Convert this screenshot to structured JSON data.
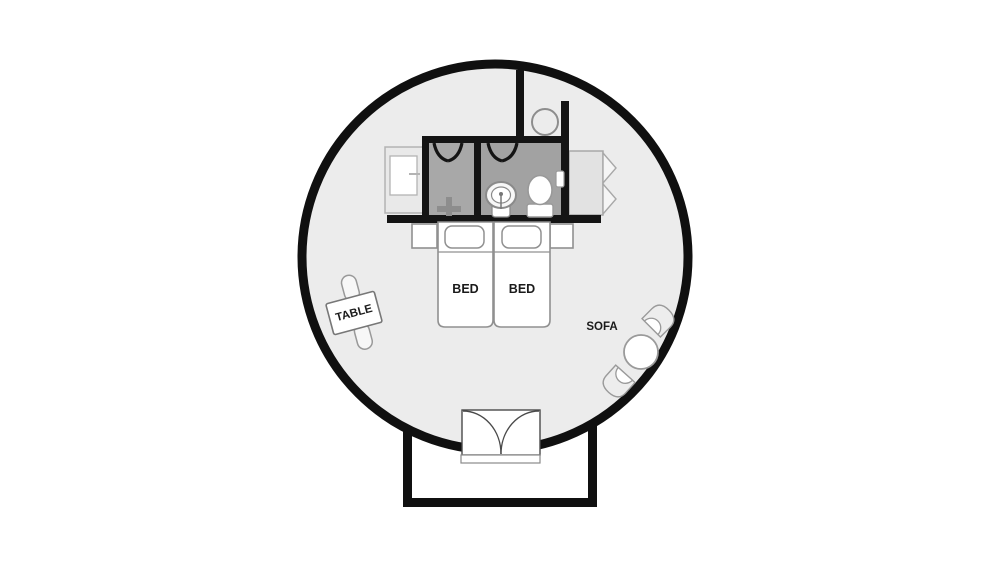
{
  "title": "Circular cabin room floor plan",
  "canvas": {
    "width": 1000,
    "height": 572,
    "background": "#ffffff"
  },
  "room": {
    "shape": "circle",
    "fill": "#ececec",
    "outline_color": "#101010",
    "outline_width": 9
  },
  "labels": {
    "bed_left": "BED",
    "bed_right": "BED",
    "table": "TABLE",
    "sofa": "SOFA"
  },
  "colors": {
    "wall": "#141414",
    "bathroom_left_fill": "#a8a8a8",
    "bathroom_right_fill": "#a2a2a2",
    "furniture_outline": "#909090",
    "furniture_fill": "#ffffff",
    "storage_fill": "#e6e6e6"
  },
  "areas": {
    "bathroom": {
      "fixtures": [
        "shower-cross-icon",
        "pedestal-sink-icon",
        "toilet-icon",
        "wall-shelf-icon"
      ],
      "doors": 2
    },
    "niche": {
      "fixture": "round-basin-icon"
    },
    "storage": [
      "cabinet",
      "bifold-wardrobe"
    ],
    "entrance": {
      "type": "double-swing-door",
      "vestibule": true
    }
  },
  "furniture": [
    "twin-bed",
    "twin-bed",
    "pillow",
    "pillow",
    "nightstand",
    "nightstand",
    "dining-table",
    "bench",
    "bench",
    "armchair",
    "armchair",
    "round-coffee-table"
  ]
}
